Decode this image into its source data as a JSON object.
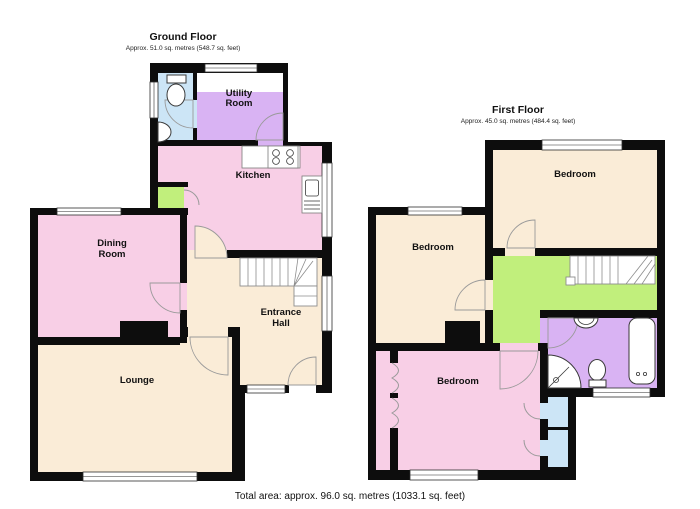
{
  "ground_floor": {
    "title": "Ground Floor",
    "area": "Approx. 51.0 sq. metres (548.7 sq. feet)",
    "rooms": {
      "utility_line1": "Utility",
      "utility_line2": "Room",
      "kitchen": "Kitchen",
      "dining_line1": "Dining",
      "dining_line2": "Room",
      "entrance_line1": "Entrance",
      "entrance_line2": "Hall",
      "lounge": "Lounge"
    }
  },
  "first_floor": {
    "title": "First Floor",
    "area": "Approx. 45.0 sq. metres (484.4 sq. feet)",
    "rooms": {
      "bedroom_right": "Bedroom",
      "bedroom_left": "Bedroom",
      "bedroom_front": "Bedroom"
    }
  },
  "footer": {
    "total_area": "Total area: approx. 96.0 sq. metres (1033.1 sq. feet)"
  },
  "colors": {
    "wall": "#0d0d0d",
    "room_pink": "#f8cfe6",
    "room_cream": "#faecd7",
    "room_purple": "#d9b3f3",
    "room_blue": "#cce5f6",
    "room_green": "#c1ef7c",
    "fixture_white": "#ffffff"
  }
}
